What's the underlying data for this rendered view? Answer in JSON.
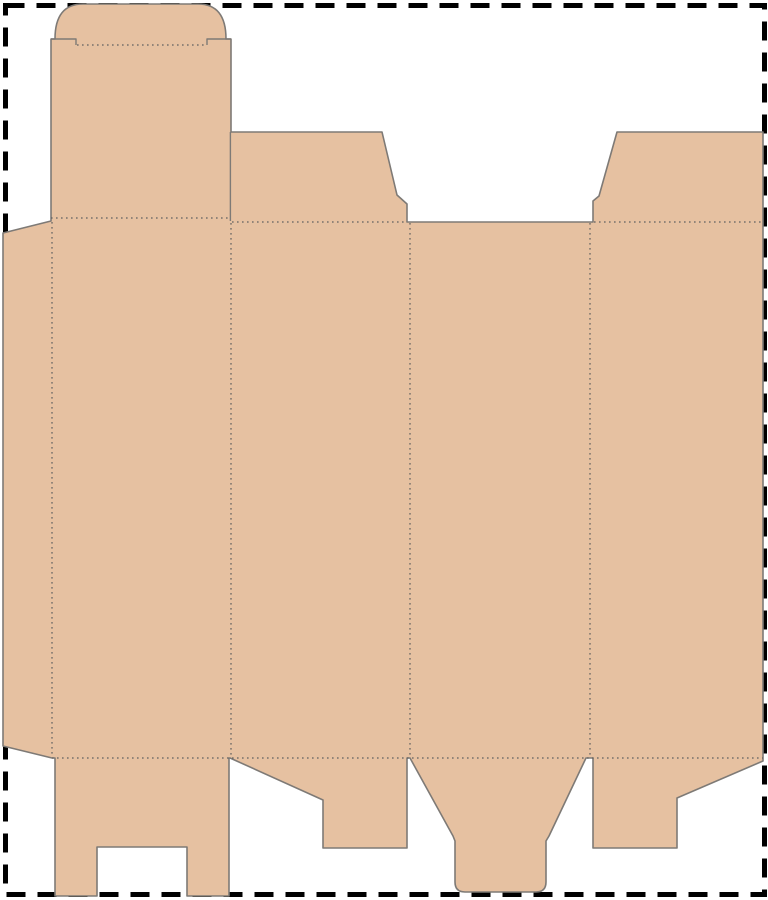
{
  "scene": {
    "type": "packaging-dieline-template",
    "description": "Flat die-cut template (dieline) of a folding carton box: tan blank with solid cut lines and dotted fold lines, placed on a white sheet bounded by a thick black dashed cutting border"
  },
  "colors": {
    "background": "#ffffff",
    "board_fill": "#e6c1a1",
    "cut_stroke": "#7e7a76",
    "fold_stroke": "#5f5f5f",
    "border_stroke": "#000000"
  },
  "sheet": {
    "width_px": 768,
    "height_px": 900,
    "border": {
      "style": "dashed",
      "stroke_width": 5,
      "dash_length": 19,
      "gap_length": 12
    }
  },
  "dieline": {
    "parts": [
      {
        "name": "glue-flap",
        "position": "far-left-edge"
      },
      {
        "name": "back-panel",
        "position": "panel-1"
      },
      {
        "name": "lid-panel",
        "position": "above-panel-1"
      },
      {
        "name": "tuck-flap",
        "position": "top-of-lid",
        "shape": "rounded-top"
      },
      {
        "name": "top-dust-flap-left",
        "position": "above-panel-2",
        "shape": "trapezoid"
      },
      {
        "name": "side-panel-left",
        "position": "panel-2"
      },
      {
        "name": "front-panel",
        "position": "panel-3",
        "note": "no-top-flap"
      },
      {
        "name": "side-panel-right",
        "position": "panel-4",
        "note": "clipped-at-right-sheet-edge"
      },
      {
        "name": "top-dust-flap-right",
        "position": "above-panel-4",
        "shape": "trapezoid"
      },
      {
        "name": "bottom-lock-flap-slotted",
        "position": "below-panel-1",
        "shape": "two-legs-with-center-slot"
      },
      {
        "name": "bottom-dust-flap-left",
        "position": "below-panel-2",
        "shape": "slope-with-leg"
      },
      {
        "name": "bottom-tuck-tongue",
        "position": "below-panel-3",
        "shape": "funnel-with-rounded-tongue"
      },
      {
        "name": "bottom-dust-flap-right",
        "position": "below-panel-4",
        "shape": "slope-with-leg"
      }
    ],
    "fold_line_style": "dotted",
    "cut_line_style": "solid",
    "paths": {
      "outline": "M3,233 L51,221 L51,39 L55,39 C55,16 64,4 83,4 L198,4 C217,4 226,16 226,39 L231,39 L231,132 L382,132 L397,195 L407,204 L407,222 L593,222 L593,201 L599,196 L617,132 L763,132 L763,761 L677,798 L677,848 L593,848 L593,758 L586,758 L549,836 L546,841 L546,882 Q546,892 536,892 L465,892 Q455,892 455,882 L455,841 L453,836 L410,758 L407,758 L407,848 L323,848 L323,800 L230,758 L229,758 L229,896 L187,896 L187,847 L97,847 L97,896 L55,896 L55,758 L52,758 L3,746 Z",
      "internal_cuts": "M51,39 L76,39 L76,45 M207,45 L207,39 L231,39 M230.4,132 L230.4,221",
      "fold_lines": "M77,45 L206,45 M51,218 L230,218 M232,222 L406,222 M594,222 L762,222 M52,222 L52,757 M231,223 L231,757 M410,223 L410,757 M590,223 L590,757 M52,758 L763,758"
    }
  }
}
